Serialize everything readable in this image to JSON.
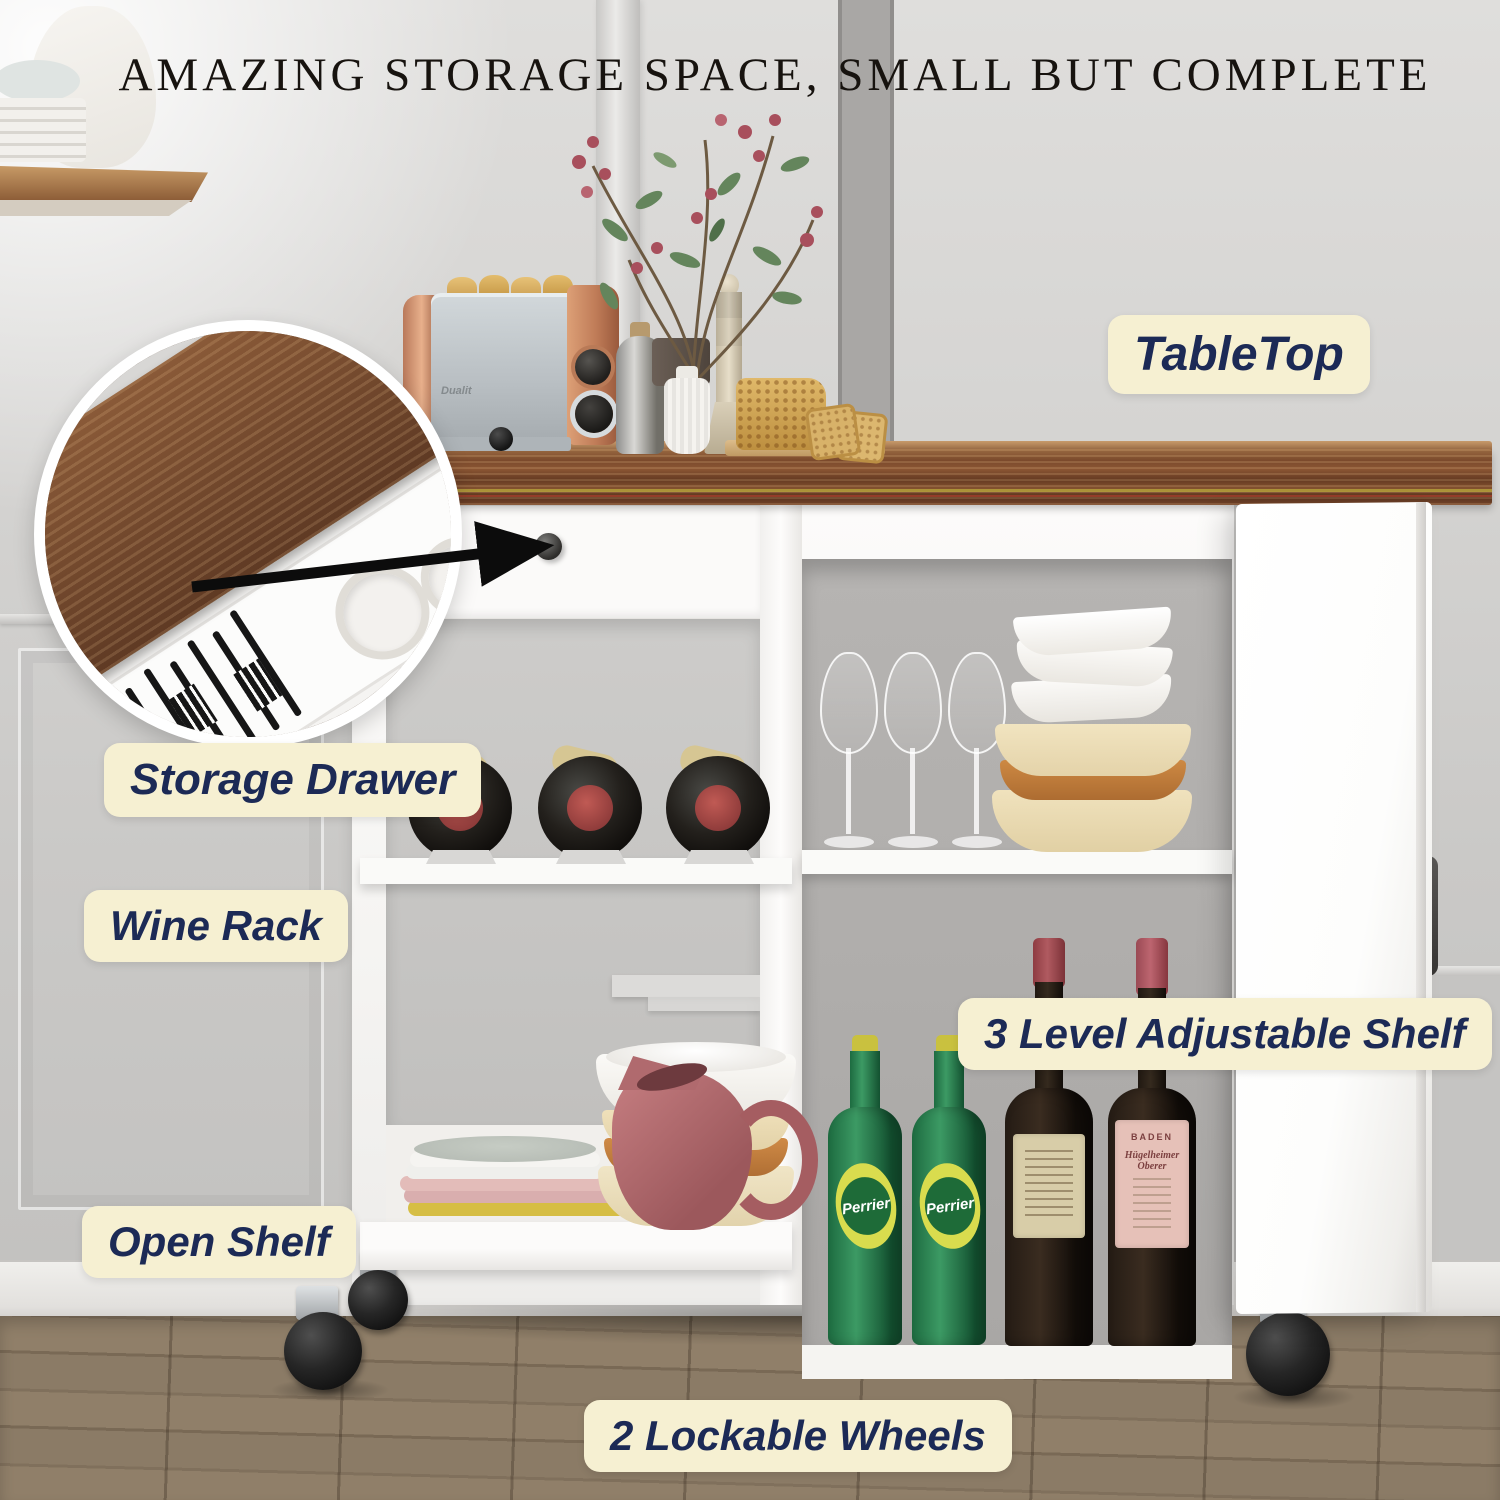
{
  "title": "AMAZING STORAGE SPACE, SMALL BUT COMPLETE",
  "callouts": {
    "tabletop": "TableTop",
    "storage_drawer": "Storage Drawer",
    "wine_rack": "Wine Rack",
    "adjustable_shelf": "3 Level Adjustable Shelf",
    "open_shelf": "Open Shelf",
    "lockable_wheels": "2 Lockable Wheels"
  },
  "products": {
    "toaster_brand": "Dualit",
    "perrier": "Perrier",
    "wine_region": "BADEN",
    "wine_name": "Hügelheimer Oberer"
  },
  "colors": {
    "callout_bg": "#f6f0d2",
    "callout_text": "#1c2a56",
    "title_text": "#17130f",
    "wall": "#d6d5d3",
    "floor": "#8b7b66",
    "tabletop_wood": "#74452a",
    "cart_white": "#fbfaf9",
    "interior_back": "#b0aeac",
    "toaster_copper": "#c9855f",
    "toaster_silver": "#c3c9cd",
    "perrier_green": "#2c7d4e",
    "wine_bottle": "#241b14",
    "pitcher_mauve": "#ad6366",
    "bowl_cream": "#ecdcb4",
    "bowl_orange": "#c17c3e",
    "plate_yellow": "#d6be44",
    "plate_pink": "#d9aeae"
  }
}
